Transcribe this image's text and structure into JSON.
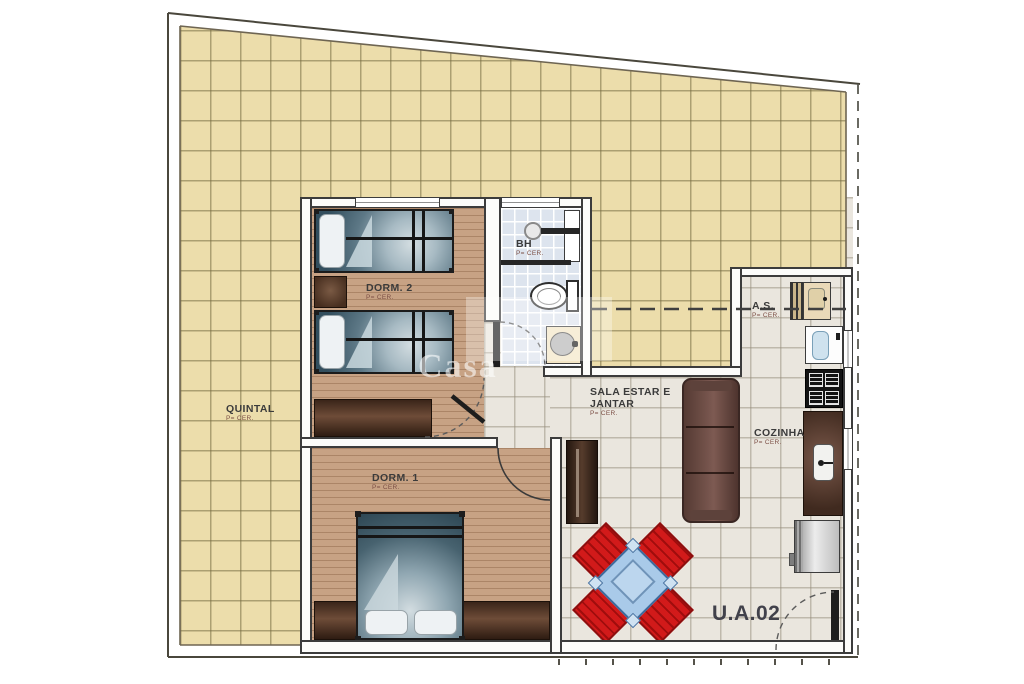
{
  "plan": {
    "unit": {
      "label": "U.A.02"
    },
    "watermark": {
      "text": "Casa"
    },
    "rooms": [
      {
        "id": "quintal",
        "name": "QUINTAL",
        "floor": "P= CER."
      },
      {
        "id": "dorm2",
        "name": "DORM. 2",
        "floor": "P= CER."
      },
      {
        "id": "bh",
        "name": "BH",
        "floor": "P= CER."
      },
      {
        "id": "dorm1",
        "name": "DORM. 1",
        "floor": "P= CER."
      },
      {
        "id": "sala",
        "name1": "SALA ESTAR E",
        "name2": "JANTAR",
        "floor": "P= CER."
      },
      {
        "id": "as",
        "name": "A.S.",
        "floor": "P= CER."
      },
      {
        "id": "cozinha",
        "name": "COZINHA",
        "floor": "P= CER."
      }
    ],
    "colors": {
      "yard_tile": "#ecddab",
      "ceramic_tile": "#eae6de",
      "wood_floor": "#c7a284",
      "bath_tile": "#dde4ee",
      "wall_line": "#3c3c3c",
      "furniture_brown": "#5d4334",
      "sofa_brown": "#6f4f45",
      "table_blue": "#a9cae9",
      "chair_red": "#d21a1a",
      "blanket_teal": "#47626f"
    }
  }
}
